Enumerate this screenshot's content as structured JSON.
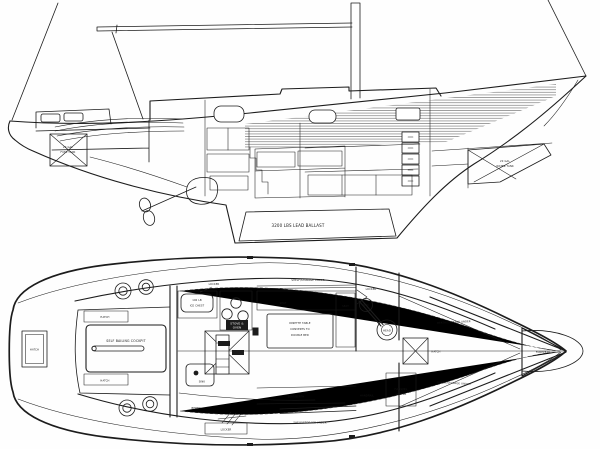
{
  "colors": {
    "ink": "#1c1c1c",
    "paper": "#ffffff"
  },
  "profile_view": {
    "fuel_tank_line1": "20 GAL",
    "fuel_tank_line2": "FUEL TANK",
    "water_tank_line1": "20 GAL",
    "water_tank_line2": "WATER TANK",
    "ballast_label": "3200 LBS LEAD BALLAST"
  },
  "plan_view": {
    "stern_hatch": "HATCH",
    "hatch_aft_top": "HATCH",
    "hatch_aft_bottom": "HATCH",
    "cockpit_label": "SELF BAILING COCKPIT",
    "locker_galley": "LOCKER",
    "ice_chest_line1": "100 LB",
    "ice_chest_line2": "ICE CHEST",
    "stove_line1": "STOVE &",
    "stove_line2": "OVEN",
    "galley_sink": "SINK",
    "quarter_berth": "BERTH",
    "locker_aft": "LOCKER",
    "shelf_top": "SHELF/STORAGE UNDER",
    "seat_aft": "SEAT",
    "seat_fwd": "SEAT",
    "dinette_line1": "DINETTE TABLE",
    "dinette_line2": "CONVERTS TO",
    "dinette_line3": "DOUBLE BED",
    "seat_berth": "SEAT/BERTH",
    "shelf_bottom": "SHELF/STORAGE UNDER",
    "locker_head": "LOCKER",
    "head_sink": "SINK",
    "head_label": "HEAD",
    "fwd_hatch": "HATCH",
    "vberth_upper": "BERTH/STORAGE UNDER",
    "vberth_lower": "BERTH/STORAGE UNDER",
    "hanging_line1": "HANGING",
    "hanging_line2": "LOCKER",
    "handrail": "HANDRAIL",
    "forepeak": "FOREPEAK"
  }
}
